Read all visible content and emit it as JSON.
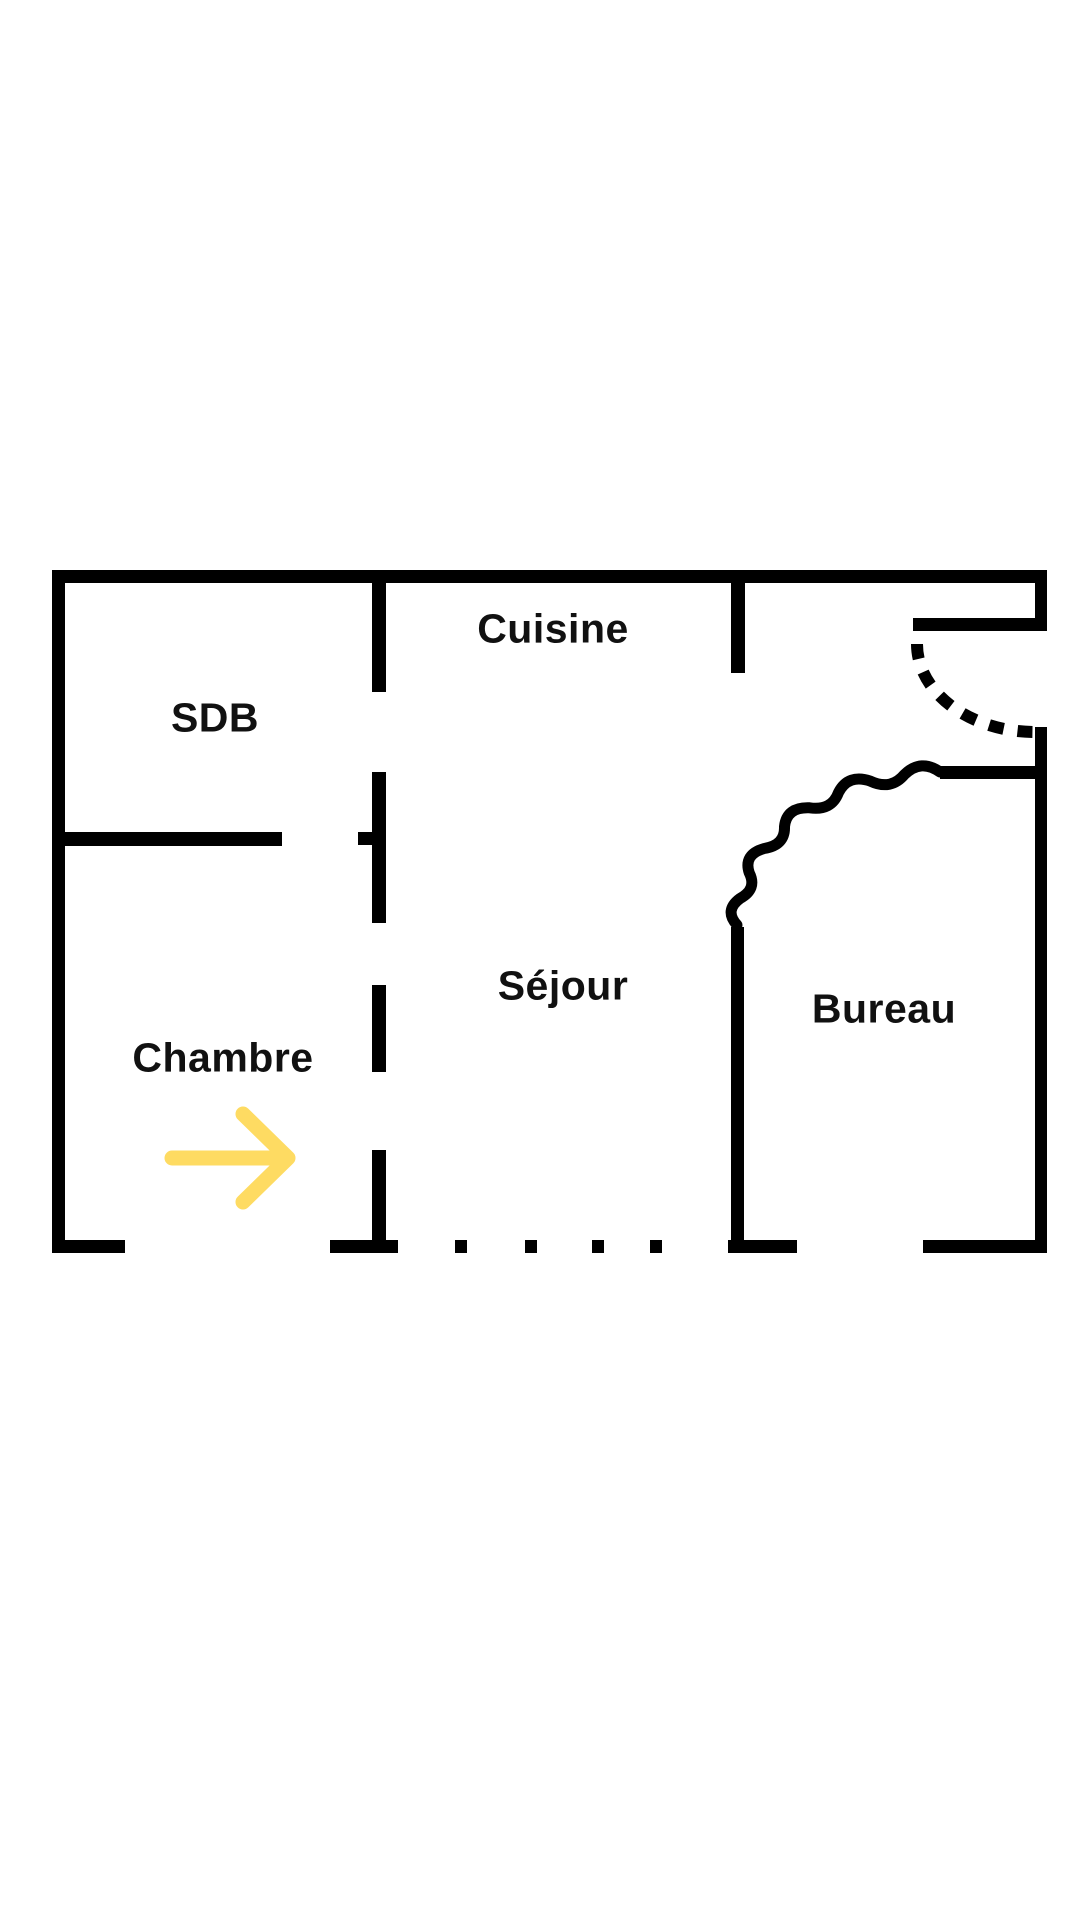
{
  "image_type": "floor_plan",
  "floor_plan": {
    "rooms": [
      {
        "id": "cuisine",
        "label": "Cuisine"
      },
      {
        "id": "sdb",
        "label": "SDB"
      },
      {
        "id": "sejour",
        "label": "Séjour"
      },
      {
        "id": "chambre",
        "label": "Chambre"
      },
      {
        "id": "bureau",
        "label": "Bureau"
      }
    ],
    "annotations": {
      "entry_arrow_direction": "right"
    },
    "colors": {
      "wall": "#000000",
      "background": "#ffffff",
      "arrow": "#FEDB62",
      "text": "#111111"
    }
  }
}
